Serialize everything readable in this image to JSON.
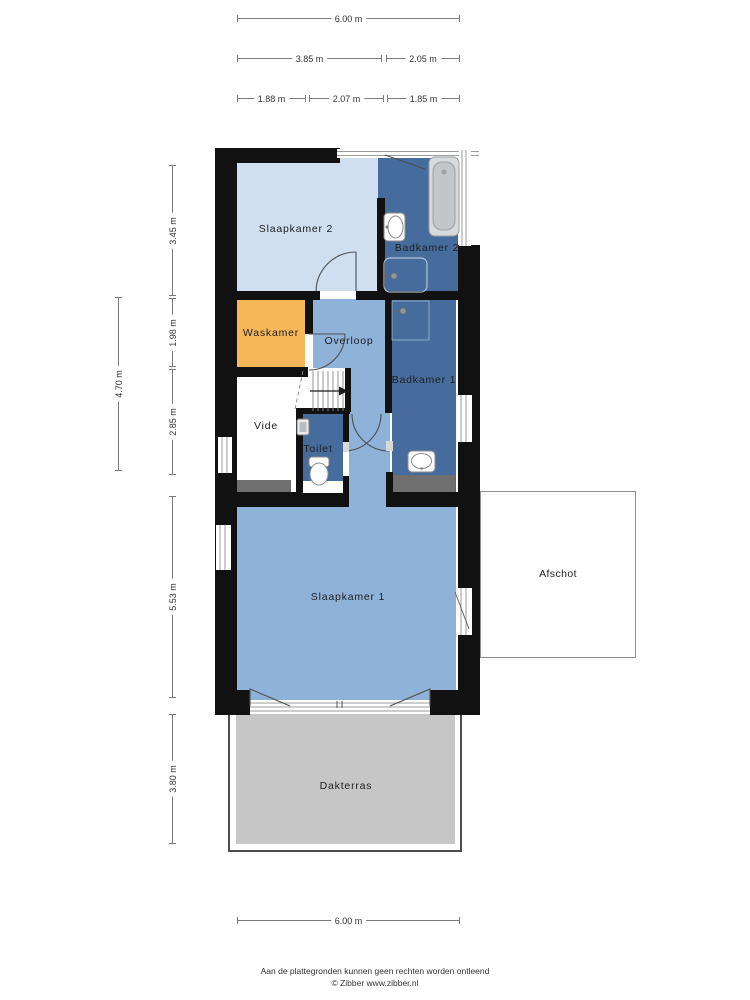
{
  "rooms": {
    "slaapkamer2": {
      "label": "Slaapkamer 2",
      "color": "#cfdfef"
    },
    "badkamer2": {
      "label": "Badkamer 2",
      "color": "#466c9d"
    },
    "waskamer": {
      "label": "Waskamer",
      "color": "#f5b75a"
    },
    "overloop": {
      "label": "Overloop",
      "color": "#8fb2d9"
    },
    "corridor": {
      "label": "",
      "color": "#8fb2d9"
    },
    "badkamer1": {
      "label": "Badkamer 1",
      "color": "#466c9d"
    },
    "vide": {
      "label": "Vide",
      "color": "#ffffff"
    },
    "stairs_area": {
      "label": "",
      "color": "#ffffff"
    },
    "toilet": {
      "label": "Toilet",
      "color": "#466c9d"
    },
    "slaapkamer1": {
      "label": "Slaapkamer 1",
      "color": "#8fb2d9"
    },
    "afschot": {
      "label": "Afschot",
      "color": "#ffffff"
    },
    "dakterras": {
      "label": "Dakterras",
      "color": "#c6c6c6"
    }
  },
  "dimensions": {
    "top": [
      {
        "label": "6.00 m"
      },
      {
        "label": "3.85 m"
      },
      {
        "label": "2.05 m"
      },
      {
        "label": "1.88 m"
      },
      {
        "label": "2.07 m"
      },
      {
        "label": "1.85 m"
      }
    ],
    "left": [
      {
        "label": "3.45 m"
      },
      {
        "label": "1.98 m"
      },
      {
        "label": "2.85 m"
      },
      {
        "label": "4.70 m"
      },
      {
        "label": "5.53 m"
      },
      {
        "label": "3.80 m"
      }
    ],
    "bottom": [
      {
        "label": "6.00 m"
      }
    ]
  },
  "fixtures": [
    "bathtub",
    "sink",
    "shower-head",
    "shower-area",
    "toilet-bowl",
    "stairs",
    "stairs-arrow"
  ],
  "colors": {
    "wall": "#111111",
    "room_light_blue": "#cfdfef",
    "room_medium_blue": "#8fb2d9",
    "room_dark_blue": "#466c9d",
    "room_orange": "#f5b75a",
    "terrace_gray": "#c6c6c6",
    "knee_wall_gray": "#6f6f6f",
    "dimension_line": "#7a7a7a"
  },
  "footer": {
    "line1": "Aan de plattegronden kunnen geen rechten worden ontleend",
    "line2": "© Zibber www.zibber.nl"
  }
}
